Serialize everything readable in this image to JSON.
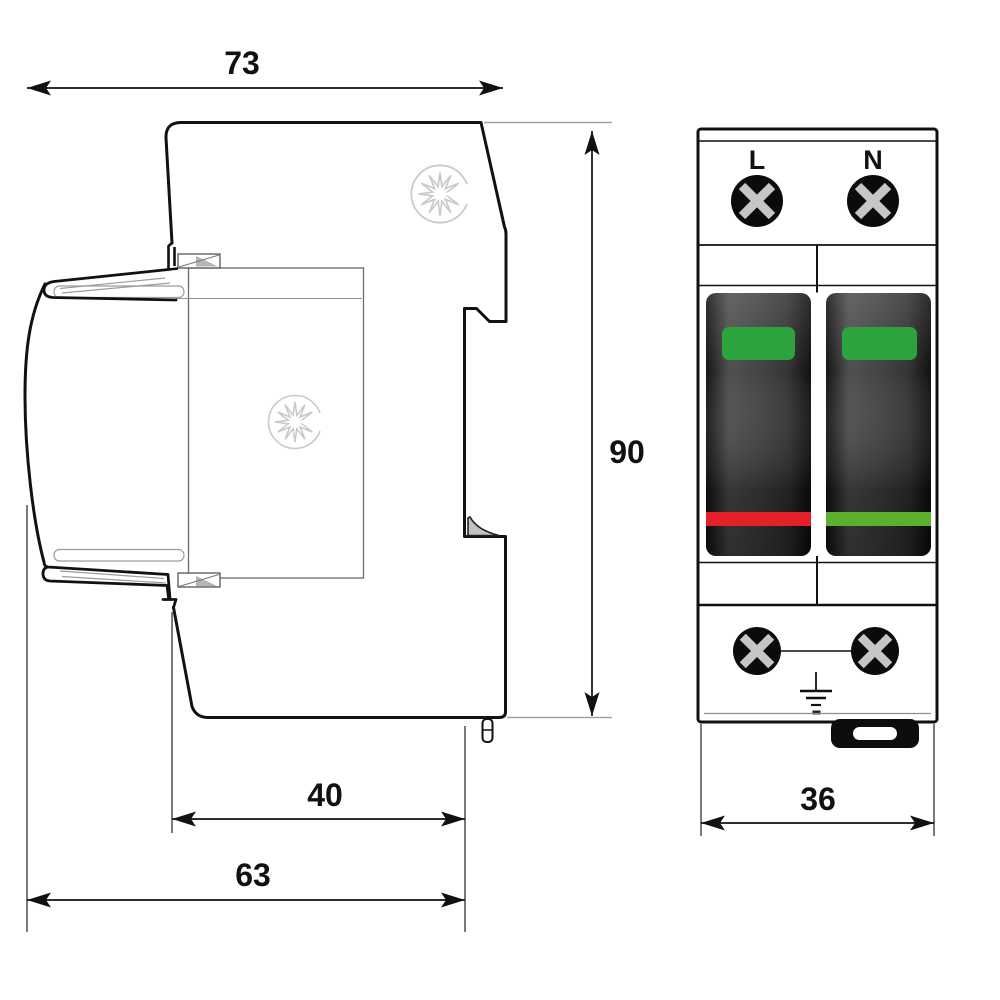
{
  "canvas": {
    "width": 1000,
    "height": 1000,
    "background": "#ffffff"
  },
  "side_view": {
    "dims": {
      "total_width": "73",
      "height": "90",
      "lower_width": "40",
      "base_width": "63"
    }
  },
  "front_view": {
    "dims": {
      "module_width": "36"
    },
    "terminals": {
      "left_label": "L",
      "right_label": "N"
    }
  },
  "colors": {
    "line": "#111111",
    "thin_gray": "#8f8f8f",
    "logo_gray": "#c9c9c9",
    "indicator_green": "#2ca33c",
    "strip_red": "#e6202b",
    "strip_green": "#5bb02e",
    "screw_black": "#0b0b0b",
    "screw_cross_gray": "#c6c6c6",
    "latch_black": "#0d0d0d"
  },
  "icons": {
    "sunburst": "sunburst-logo-icon",
    "screw": "phillips-screw-icon",
    "ground": "earth-ground-icon"
  }
}
